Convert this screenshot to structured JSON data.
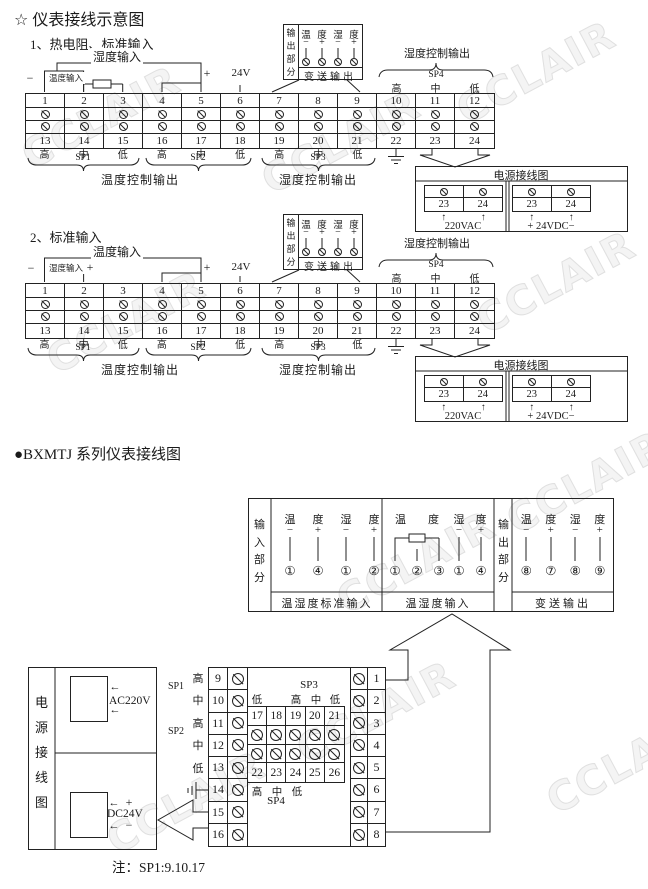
{
  "watermark": "CCLAIR",
  "headings": {
    "title": "☆ 仪表接线示意图",
    "sec1": "1、热电阻、标准输入",
    "sec2": "2、标准输入",
    "bxmtj": "●BXMTJ 系列仪表接线图",
    "note": "注：SP1:9.10.17"
  },
  "wire_labels": {
    "temp_input": "温度输入",
    "humi_input": "湿度输入",
    "minus": "−",
    "plus": "+",
    "v24": "24V"
  },
  "callout": {
    "side_label": "输出部分",
    "headers": [
      "温",
      "度",
      "湿",
      "度"
    ],
    "signs": [
      "−",
      "+",
      "−",
      "+"
    ],
    "bottom_label": "变送输出"
  },
  "strip": {
    "top": [
      "1",
      "2",
      "3",
      "4",
      "5",
      "6",
      "7",
      "8",
      "9",
      "10",
      "11",
      "12"
    ],
    "bottom": [
      "13",
      "14",
      "15",
      "16",
      "17",
      "18",
      "19",
      "20",
      "21",
      "22",
      "23",
      "24"
    ],
    "hml": [
      "高",
      "中",
      "低",
      "高",
      "中",
      "低",
      "高",
      "中",
      "低"
    ]
  },
  "sp": {
    "sp1": "SP1",
    "sp2": "SP2",
    "sp3": "SP3",
    "sp4": "SP4"
  },
  "outputs": {
    "temp": "温度控制输出",
    "humi": "湿度控制输出"
  },
  "sp4_block": {
    "hml": [
      "高",
      "中",
      "低"
    ]
  },
  "power": {
    "title": "电源接线图",
    "terms": [
      "23",
      "24"
    ],
    "arrow": "↑",
    "ac": "220VAC",
    "dc": "+ 24VDC−"
  },
  "bx": {
    "input_side": "输入部分",
    "output_side": "输出部分",
    "panel1": {
      "headers": [
        "温",
        "度",
        "湿",
        "度"
      ],
      "signs": [
        "−",
        "+",
        "−",
        "+"
      ],
      "pins": [
        "①",
        "④",
        "①",
        "②"
      ],
      "label": "温湿度标准输入"
    },
    "panel2": {
      "headers_t": [
        "温",
        "度"
      ],
      "headers_h": [
        "湿",
        "度"
      ],
      "signs": [
        "−",
        "+"
      ],
      "pins_rtd": [
        "①",
        "②",
        "③"
      ],
      "pins_h": [
        "①",
        "④"
      ],
      "label": "温湿度输入"
    },
    "panel3": {
      "headers": [
        "温",
        "度",
        "湿",
        "度"
      ],
      "signs": [
        "−",
        "+",
        "−",
        "+"
      ],
      "pins": [
        "⑧",
        "⑦",
        "⑧",
        "⑨"
      ],
      "label": "变送输出"
    },
    "rear": {
      "left_nums": [
        "9",
        "10",
        "11",
        "12",
        "13",
        "14",
        "15",
        "16"
      ],
      "right_nums": [
        "1",
        "2",
        "3",
        "4",
        "5",
        "6",
        "7",
        "8"
      ],
      "left_labels": [
        "高",
        "中",
        "高",
        "中",
        "低"
      ],
      "sp1": "SP1",
      "sp2": "SP2",
      "sp3": "SP3",
      "sp4": "SP4",
      "inner_top": [
        "17",
        "18",
        "19",
        "20",
        "21"
      ],
      "inner_bottom": [
        "22",
        "23",
        "24",
        "25",
        "26"
      ],
      "inner_top_labels": [
        "低",
        "",
        "高",
        "中",
        "低"
      ],
      "inner_bottom_labels": [
        "高",
        "中",
        "低"
      ]
    },
    "power": {
      "title": "电源接线图",
      "terms": [
        "15",
        "16"
      ],
      "arrow": "←",
      "ac": "AC220V",
      "dc": "DC24V",
      "plus": "+",
      "minus": "−"
    }
  }
}
